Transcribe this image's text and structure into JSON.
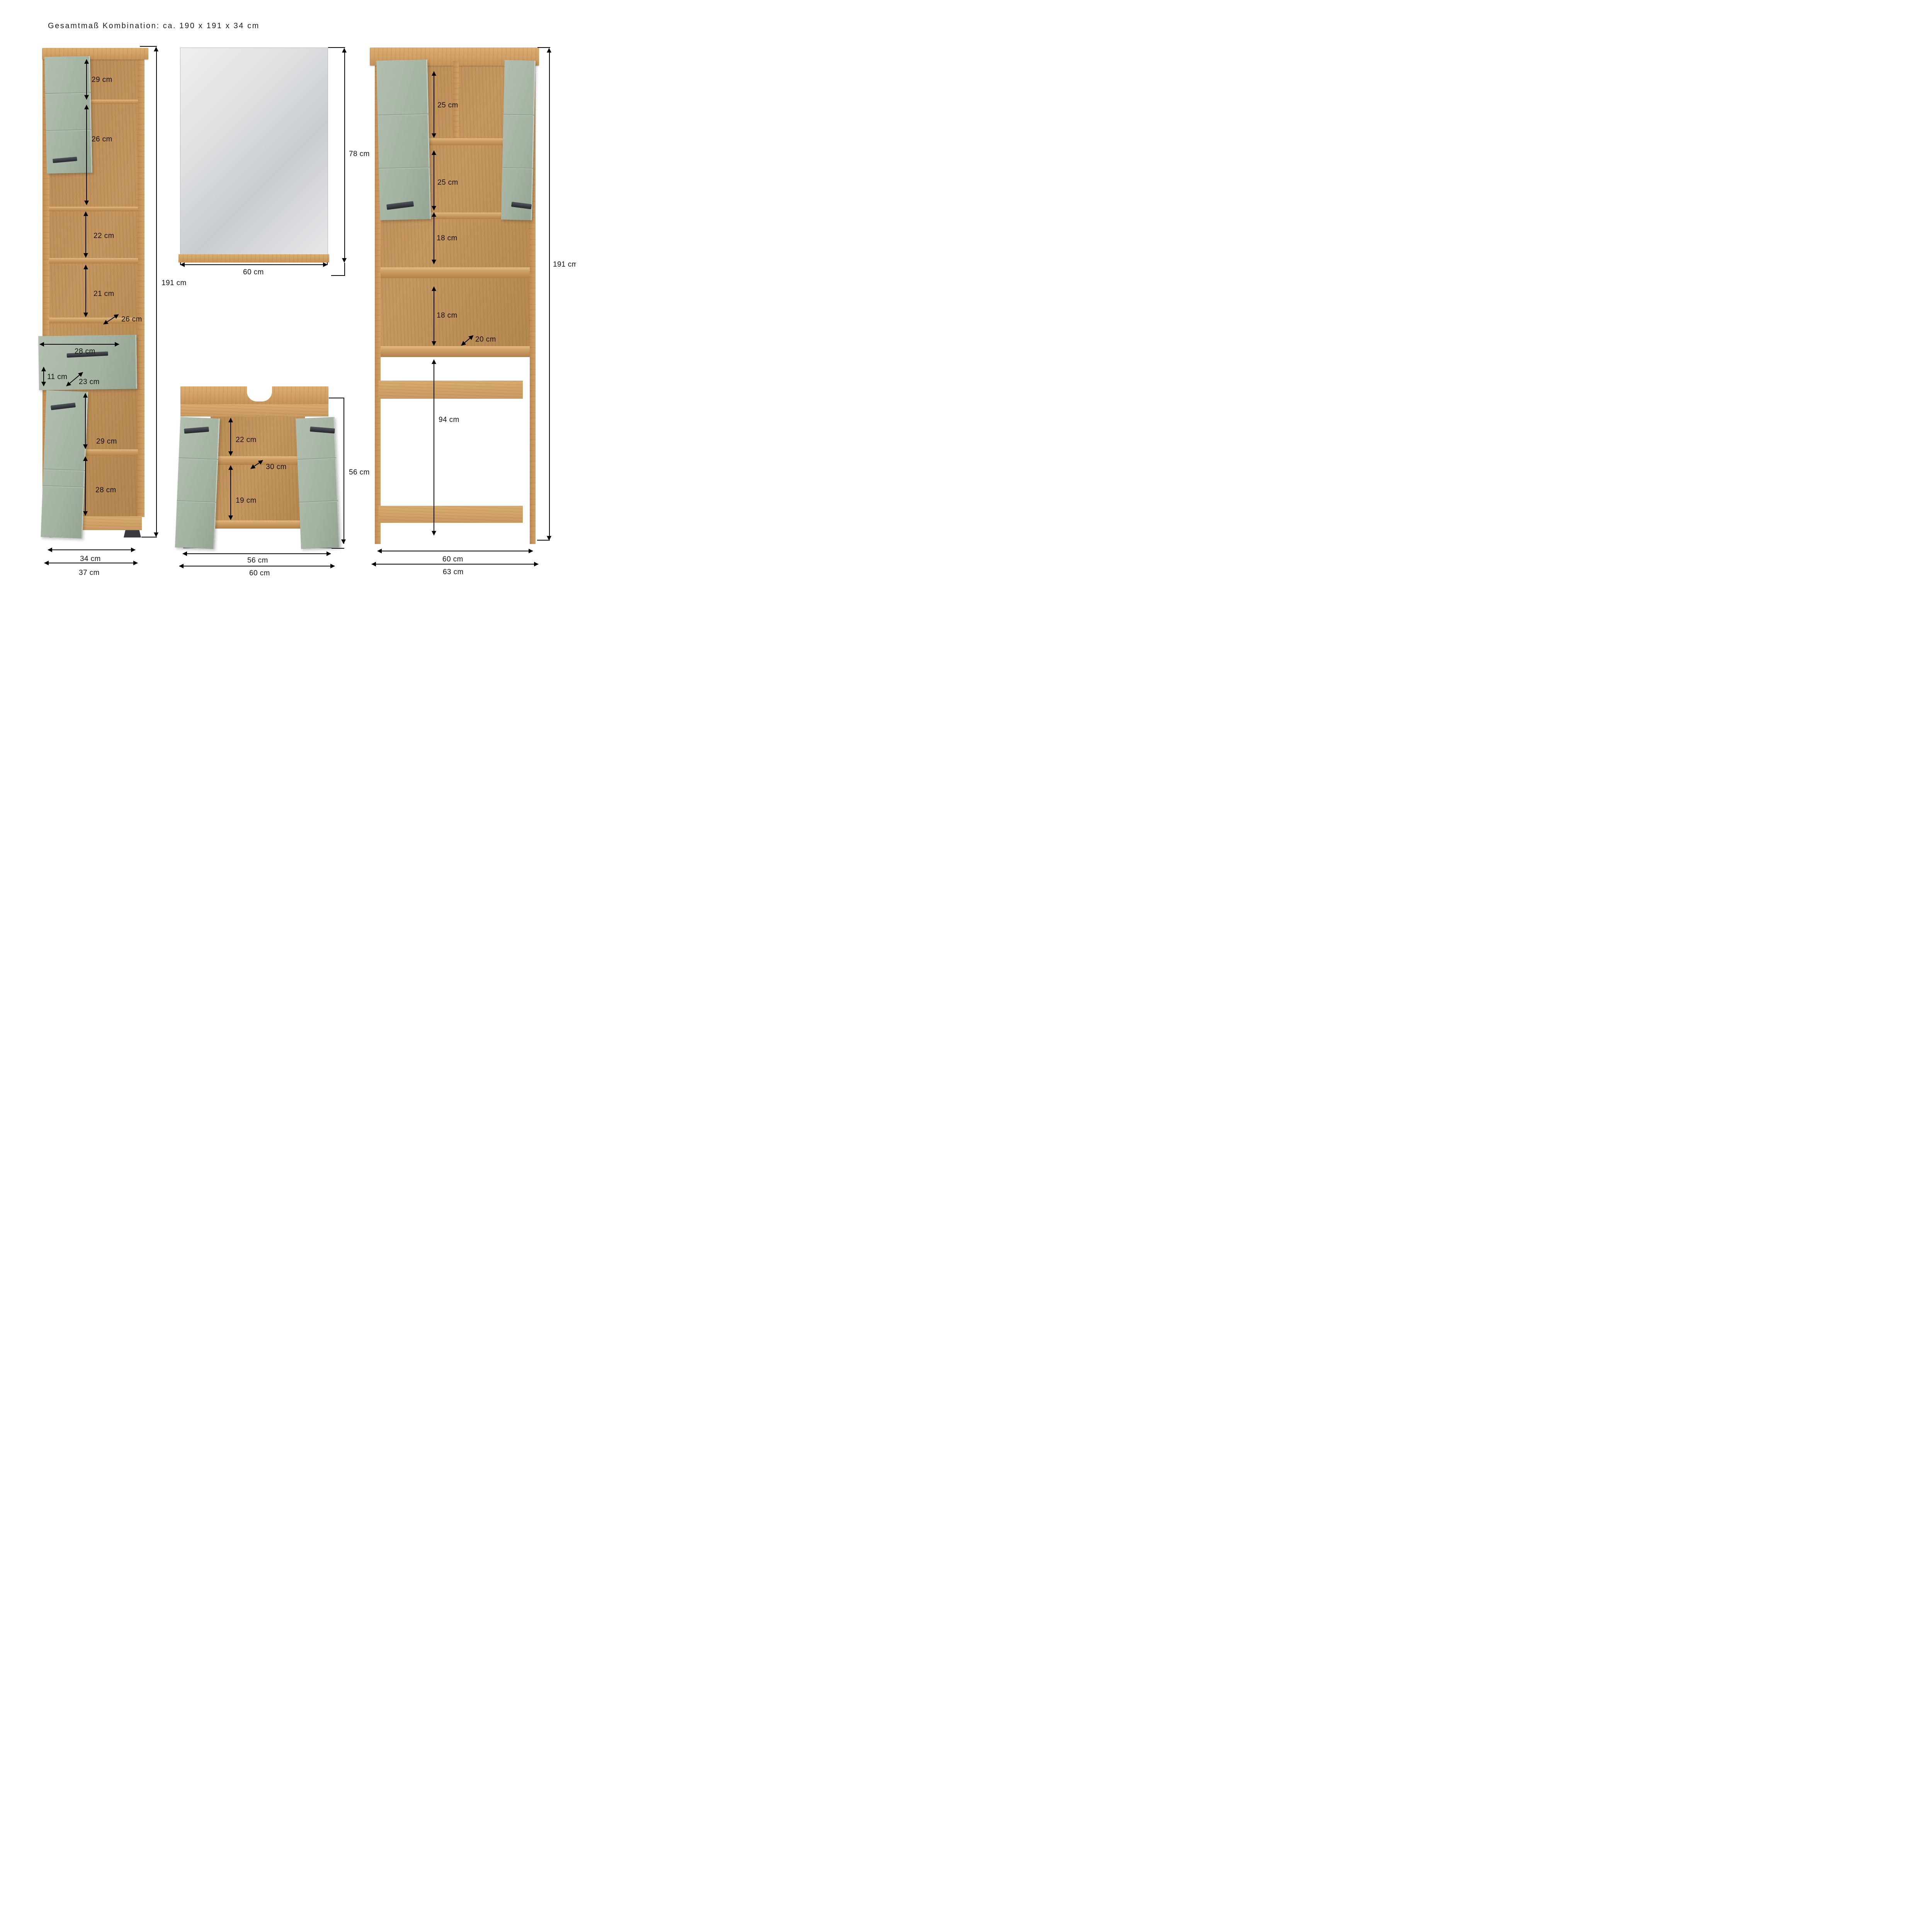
{
  "title": "Gesamtmaß Kombination: ca. 190 x 191 x 34 cm",
  "unit": "cm",
  "colors": {
    "wood": "#c99a63",
    "wood_dark": "#b98c55",
    "sage_green": "#a6b4a4",
    "handle_dark": "#33363b",
    "dimension_line": "#000000",
    "mirror_glass": "#d9dbdd",
    "background": "#ffffff"
  },
  "tall_cabinet": {
    "dimensions": {
      "top_compartment": "29 cm",
      "second_compartment": "26 cm",
      "open_shelf_upper": "22 cm",
      "open_shelf_lower": "21 cm",
      "open_depth": "26 cm",
      "drawer_width": "28 cm",
      "drawer_front_height": "11 cm",
      "drawer_depth": "23 cm",
      "door_compartment": "29 cm",
      "bottom_compartment": "28 cm",
      "total_height": "191 cm",
      "body_width": "34 cm",
      "total_width": "37 cm"
    }
  },
  "mirror": {
    "dimensions": {
      "height": "78 cm",
      "width": "60 cm"
    }
  },
  "vanity": {
    "dimensions": {
      "upper_compartment": "22 cm",
      "shelf_depth": "30 cm",
      "lower_compartment": "19 cm",
      "total_height": "56 cm",
      "body_width": "56 cm",
      "total_width": "60 cm"
    }
  },
  "tower": {
    "dimensions": {
      "upper_left_compartment": "25 cm",
      "lower_left_compartment": "25 cm",
      "shelf_upper": "18 cm",
      "shelf_lower": "18 cm",
      "shelf_depth": "20 cm",
      "machine_opening": "94 cm",
      "total_height": "191 cm",
      "inner_width": "60 cm",
      "total_width": "63 cm"
    }
  }
}
